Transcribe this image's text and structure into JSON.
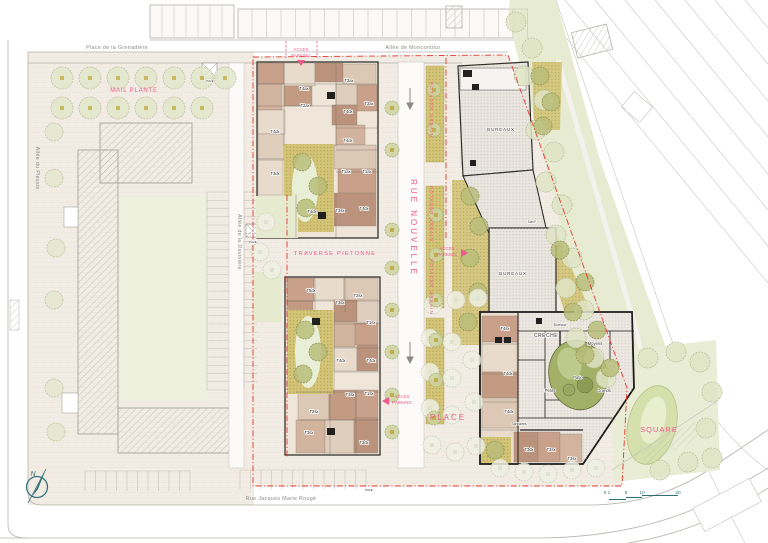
{
  "streets": {
    "place_de_la_grenadiere": "Place de la Grenadière",
    "allee_de_moncontour": "Allée de Moncontour",
    "allee_du_plessis": "Allée du Plessis",
    "allee_de_la_deviniere": "Allée de la Devinière",
    "rue_jacques_marie_rouge": "Rue Jacques Marie Rougé"
  },
  "areas": {
    "mail_plante": "MAIL PLANTE",
    "traverse_pietonne": "TRAVERSE PIETONNE",
    "rue_nouvelle": "RUE NOUVELLE",
    "potager_urbain": "POTAGER URBAIN",
    "place": "PLACE",
    "square": "SQUARE"
  },
  "access": {
    "line1": "ACCES",
    "line2": "PARKING"
  },
  "buildings": {
    "bureaux": "BUREAUX",
    "pave": "PAVE"
  },
  "creche": {
    "title": "CRECHE",
    "bureaux": "Bureaux",
    "moyens": "Moyens",
    "patio": "Patio",
    "petits": "Petits",
    "grands": "Grands",
    "sanitaires": "Sanitaires",
    "san_f": "San.F"
  },
  "units": {
    "north": [
      "T4ax",
      "T3ax",
      "T2ax",
      "T3ax",
      "T4dx",
      "T4dx",
      "T4dx",
      "T3dx",
      "T1ax",
      "T1ax",
      "T4dx",
      "T3sx",
      "T4dx"
    ],
    "south": [
      "T5dx",
      "T2sx",
      "T3sx",
      "T1sx",
      "T4dx",
      "T4dx",
      "T3sx",
      "T1sx",
      "T2sx",
      "T3sx",
      "T3dx"
    ],
    "east": [
      "T4sx",
      "T4dx",
      "T4dx",
      "T3dx",
      "T3sx",
      "T3sx"
    ]
  },
  "compass": {
    "label": "N"
  },
  "scale": {
    "ticks": [
      "0 1",
      "5",
      "10",
      "20"
    ]
  },
  "colors": {
    "annotation_pink": "#ee5a8c",
    "boundary_red": "#e03a2e",
    "compass_teal": "#2f6f79",
    "landscape_green": "#e3e8cb",
    "olive_planting": "#d3c477",
    "unit_brown": "#c9a089"
  }
}
